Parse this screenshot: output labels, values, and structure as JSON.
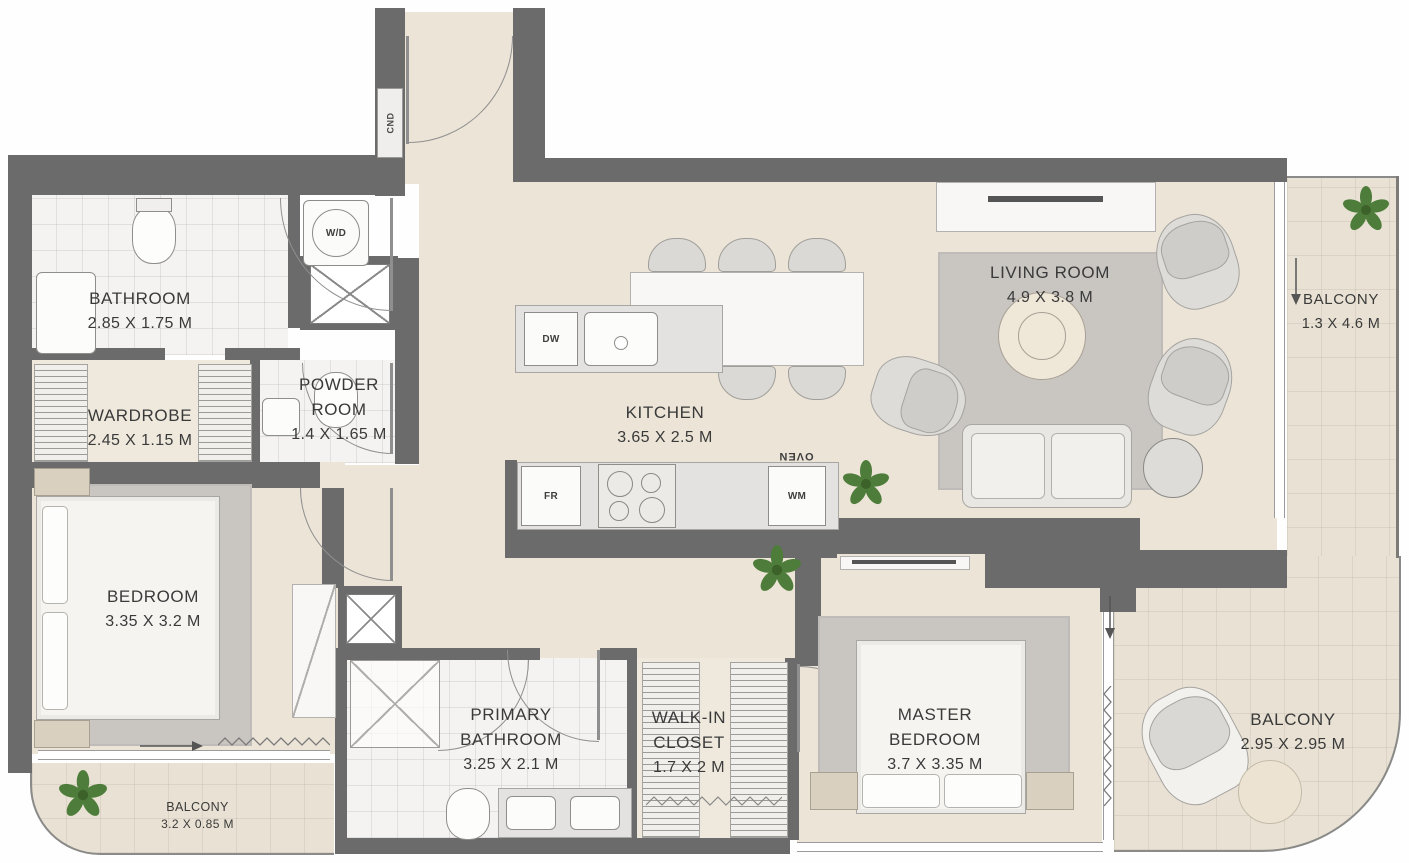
{
  "rooms": {
    "bathroom": {
      "name": "BATHROOM",
      "dims": "2.85 X 1.75 M"
    },
    "wardrobe": {
      "name": "WARDROBE",
      "dims": "2.45 X 1.15 M"
    },
    "powder_room": {
      "name": "POWDER ROOM",
      "dims": "1.4 X 1.65 M"
    },
    "kitchen": {
      "name": "KITCHEN",
      "dims": "3.65 X 2.5 M"
    },
    "living_room": {
      "name": "LIVING ROOM",
      "dims": "4.9 X 3.8 M"
    },
    "balcony_right": {
      "name": "BALCONY",
      "dims": "1.3 X 4.6 M"
    },
    "bedroom": {
      "name": "BEDROOM",
      "dims": "3.35 X 3.2 M"
    },
    "primary_bathroom": {
      "name": "PRIMARY BATHROOM",
      "dims": "3.25 X 2.1 M"
    },
    "walk_in_closet": {
      "name": "WALK-IN CLOSET",
      "dims": "1.7 X 2 M"
    },
    "master_bedroom": {
      "name": "MASTER BEDROOM",
      "dims": "3.7 X 3.35 M"
    },
    "balcony_bottom_right": {
      "name": "BALCONY",
      "dims": "2.95 X 2.95 M"
    },
    "balcony_bottom_left": {
      "name": "BALCONY",
      "dims": "3.2 X 0.85 M"
    }
  },
  "appliances": {
    "washer_dryer": "W/D",
    "dishwasher": "DW",
    "fridge": "FR",
    "washing_machine": "WM",
    "oven": "OVEN",
    "condenser": "CND"
  },
  "colors": {
    "wall": "#6b6b6b",
    "floor": "#ebe4d7",
    "balcony_floor": "#e9e2d4",
    "tile": "#f4f3f1",
    "rug": "#c9c6c2",
    "counter": "#e3e2e0",
    "marble": "#f8f7f5",
    "plant": "#4e7c3a",
    "label_text": "#3a3a3a"
  }
}
